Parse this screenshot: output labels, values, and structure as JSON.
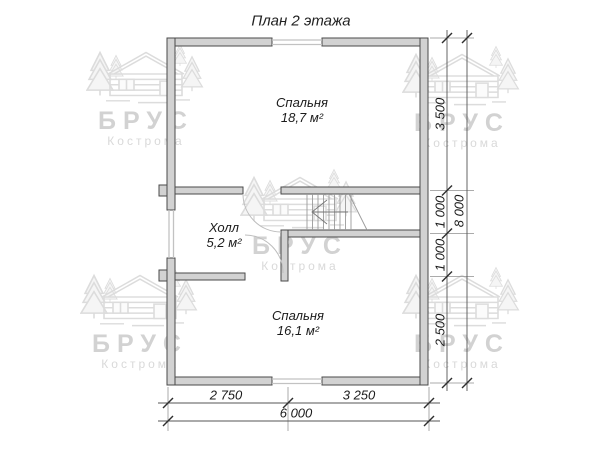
{
  "title": "План 2 этажа",
  "rooms": {
    "bedroom1": {
      "name": "Спальня",
      "area": "18,7 м²"
    },
    "hall": {
      "name": "Холл",
      "area": "5,2 м²"
    },
    "bedroom2": {
      "name": "Спальня",
      "area": "16,1 м²"
    }
  },
  "dimensions": {
    "right": [
      "3 500",
      "1 000",
      "1 000",
      "2 500"
    ],
    "right_total": "8 000",
    "bottom": [
      "2 750",
      "3 250"
    ],
    "bottom_total": "6 000"
  },
  "watermark": {
    "brand": "БРУС",
    "city": "Кострома"
  },
  "colors": {
    "wall_fill": "#d2d2d2",
    "wall_outline": "#4a4a4a",
    "window_line": "#c2c2c2",
    "dimension_line": "#555555",
    "text": "#1c1c1c",
    "watermark_gray": "#d2d2d2"
  }
}
